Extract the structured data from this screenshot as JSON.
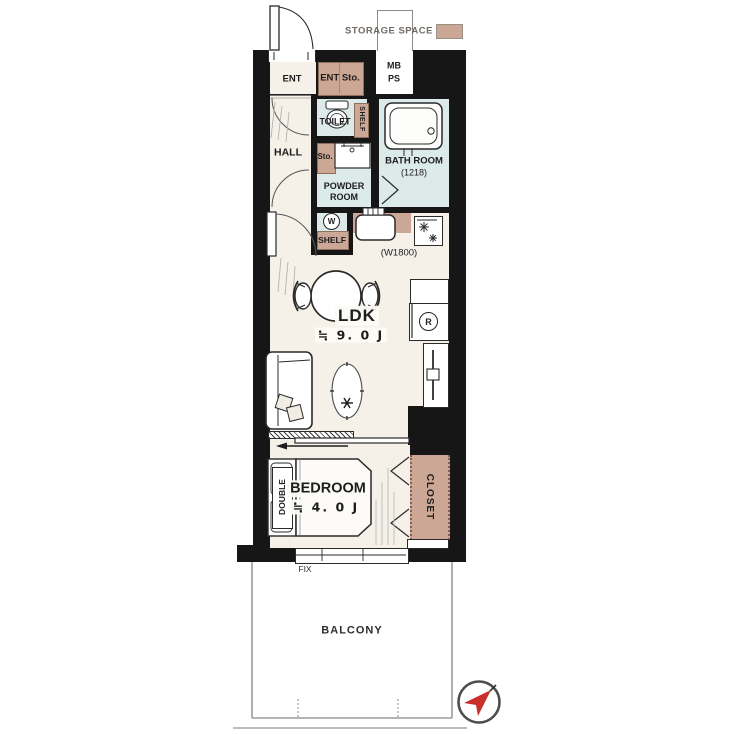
{
  "legend": {
    "storage_space": "STORAGE SPACE"
  },
  "colors": {
    "storage_tan": "#cda795",
    "wet_area_blue": "#dcebe9",
    "floor_cream": "#f5f1e9",
    "wall_black": "#161616",
    "compass_red": "#c9302c"
  },
  "rooms": {
    "ent": "ENT",
    "ent_storage": "ENT Sto.",
    "meter_box": "MB",
    "pipe_space": "PS",
    "toilet": "TOILET",
    "toilet_shelf": "SHELF",
    "hall": "HALL",
    "storage_small": "Sto.",
    "powder_room": "POWDER ROOM",
    "bath_room": "BATH ROOM",
    "bath_size": "(1218)",
    "washer_symbol": "W",
    "kitchen_shelf": "SHELF",
    "kitchen_width": "(W1800)",
    "ldk": "LDK",
    "ldk_size": "≒ 9. 0 J",
    "fridge_symbol": "R",
    "bedroom": "BEDROOM",
    "bedroom_size": "≒ 4. 0 J",
    "bed_type": "DOUBLE",
    "closet": "CLOSET",
    "window_fix": "FIX",
    "balcony": "BALCONY"
  }
}
